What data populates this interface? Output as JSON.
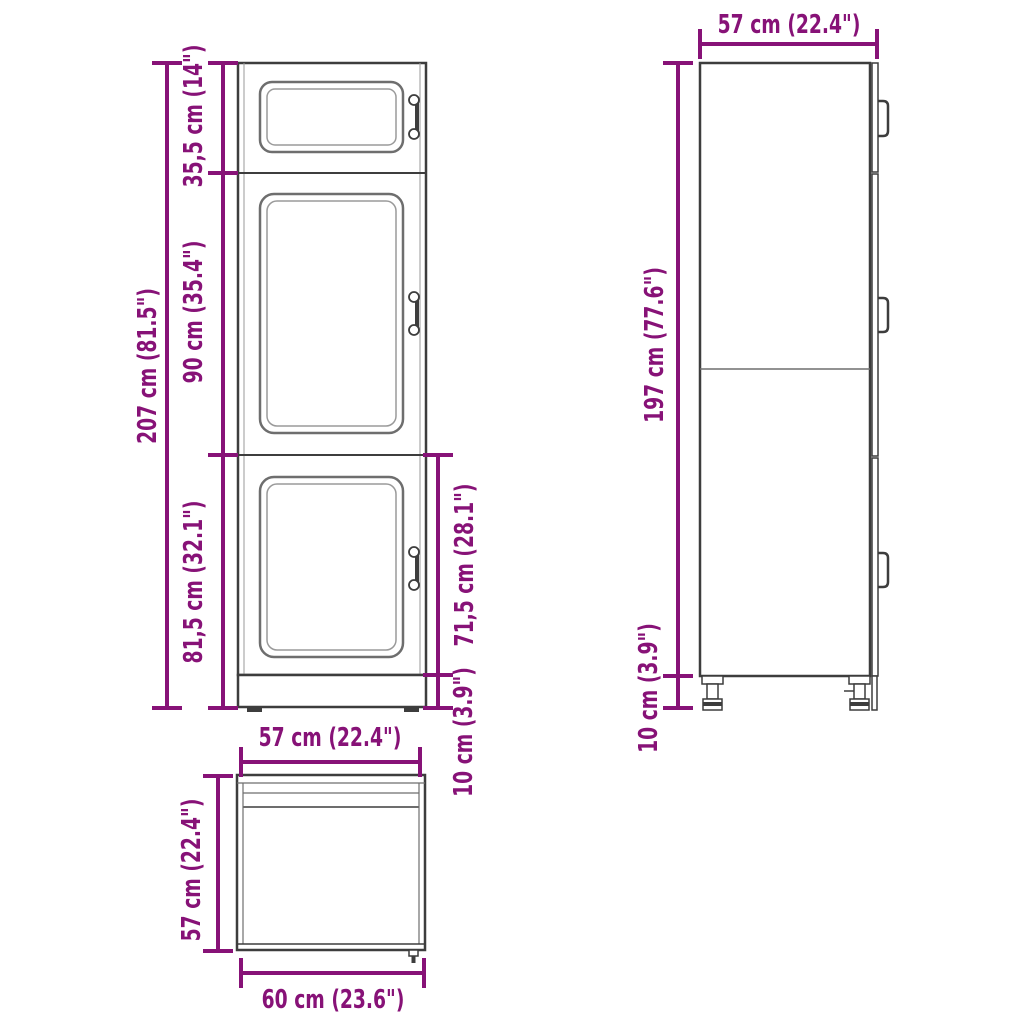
{
  "page": {
    "title": "Kitchen cabinet dimension diagram",
    "views": {
      "front_view": "front view",
      "side_view": "side view",
      "top_view": "top view"
    }
  },
  "labels": {
    "front_total_height": "207 cm (81.5\")",
    "front_top_section": "35,5 cm (14\")",
    "front_middle_section": "90 cm (35.4\")",
    "front_bottom_section": "81,5 cm (32.1\")",
    "front_lower_door_height": "71,5 cm (28.1\")",
    "front_plinth_height": "10 cm (3.9\")",
    "front_width": "57 cm (22.4\")",
    "side_depth": "57 cm (22.4\")",
    "side_body_height": "197 cm (77.6\")",
    "side_leg_height": "10 cm (3.9\")",
    "top_view_depth": "57 cm (22.4\")",
    "top_view_width": "60 cm (23.6\")"
  },
  "colors": {
    "dimension": "#871277",
    "line": "#3d3d3d",
    "panel": "#6e6e6e",
    "panel2": "#9a9a9a"
  }
}
